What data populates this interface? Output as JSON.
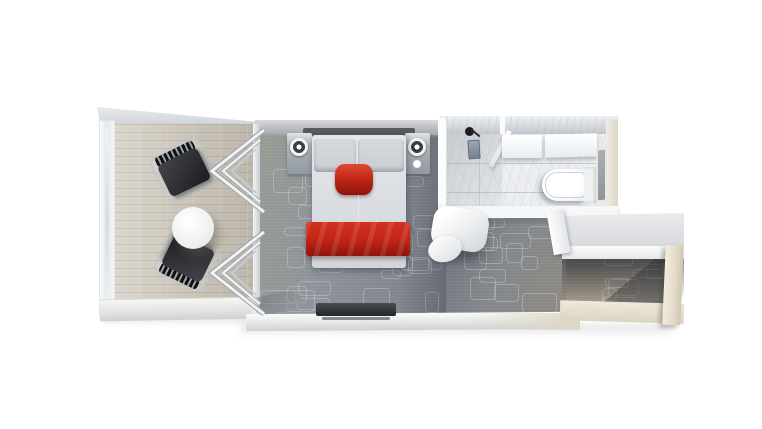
{
  "canvas": {
    "width": 762,
    "height": 429
  },
  "scene": {
    "view": "top-down 3D rendered stateroom floor plan",
    "rooms": [
      "balcony",
      "bedroom",
      "bathroom",
      "entry hall"
    ],
    "accent_items": [
      "red bed runner",
      "red bolster cushion"
    ]
  },
  "labels": {
    "stage": "Stateroom floor plan render",
    "balcony": "Private balcony",
    "railing": "Balcony railing",
    "balcony_floor": "Balcony wood decking",
    "lounge_chair": "Balcony chair",
    "balcony_table": "Round balcony table",
    "sliding_doors": "Open sliding glass doors",
    "bedroom_carpet": "Bedroom carpet",
    "nightstand": "Bedside table with lamp",
    "lamp": "Bedside lamp",
    "bed": "Double bed",
    "pillow": "Pillow",
    "red_bolster": "Red accent cushion",
    "red_blanket": "Red bed runner",
    "tv_console": "TV / media console",
    "bathroom": "Bathroom",
    "shower": "Shower area",
    "shower_head": "Shower head",
    "shower_control": "Shower control panel",
    "shower_glass": "Shower glass door",
    "vanity": "Vanity counter with sink",
    "toilet": "Toilet",
    "mirror": "Mirror",
    "armchair": "Armchair",
    "wardrobe": "Wardrobe / closet",
    "entry_door": "Entry door",
    "hall_carpet": "Entry hall carpet"
  },
  "colors": {
    "bg": "#ffffff",
    "wall_light": "#f2f3f4",
    "wall_mid": "#c2c6cc",
    "wall_dark": "#9aa0a7",
    "headboard": "#565b62",
    "balcony_floor_light": "#ded9d0",
    "balcony_floor": "#c9c3b8",
    "carpet_base": "#8d929a",
    "carpet_warm": "#8e8a80",
    "carpet_dark": "#6d7178",
    "chair_dark": "#2c2d31",
    "chair_frame": "#c3c7cc",
    "table_white": "#ffffff",
    "bed_linen": "#dcdfe3",
    "pillow": "#c9cdd2",
    "red_bright": "#d2311e",
    "red_deep": "#8e140c",
    "tv_dark": "#34373c",
    "marble": "#eceef0",
    "fixture_white": "#fbfcfd",
    "mirror_glass": "#a8aeb6",
    "beige_wall": "#e3dbc9",
    "beige_floor": "#dcd4c2"
  }
}
